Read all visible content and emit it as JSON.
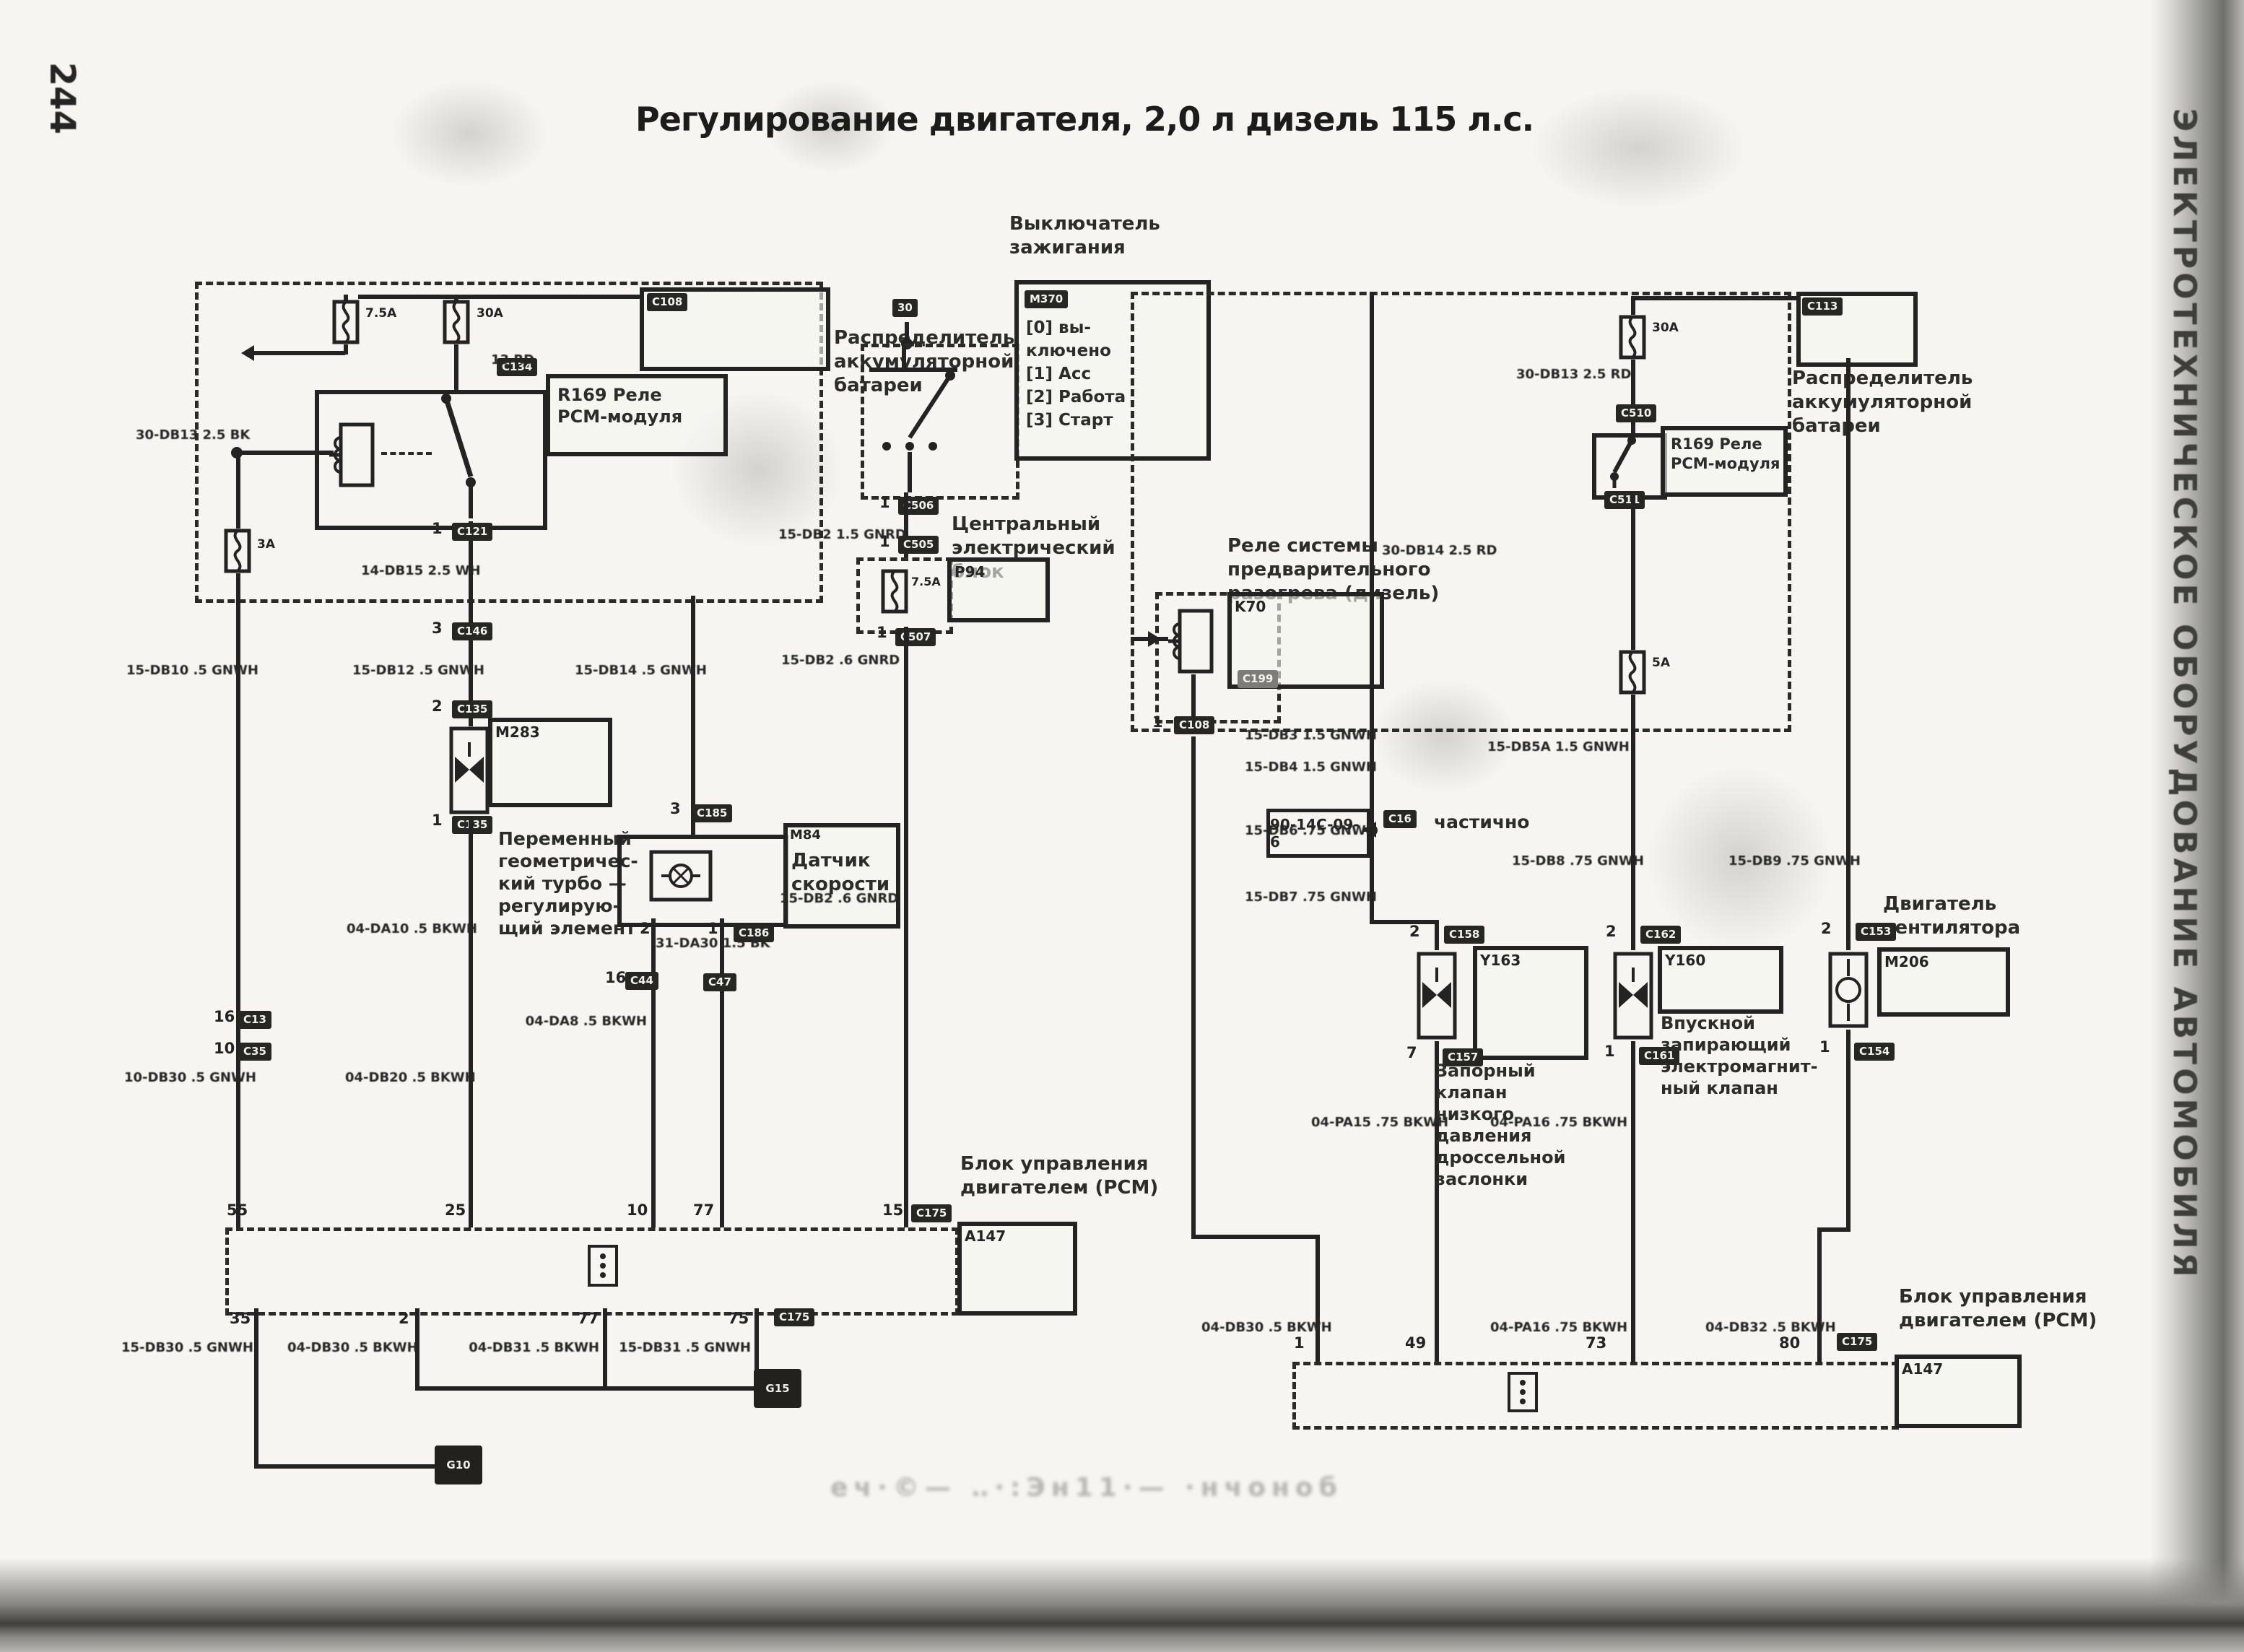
{
  "page": {
    "number": "244",
    "title": "Регулирование двигателя, 2,0 л дизель 115 л.с.",
    "sidebar": "ЭЛЕКТРОТЕХНИЧЕСКОЕ ОБОРУДОВАНИЕ АВТОМОБИЛЯ",
    "ghost": "еч·©— ‥·:Эн11·— ·нчоноб"
  },
  "left": {
    "dist1": "Распределитель",
    "dist2": "аккумуляторной",
    "dist3": "батареи",
    "dist_tag": "C108",
    "fuse1": "7.5A",
    "fuse2": "30A",
    "fuse3": "3A",
    "cb_fuse": "7.5A",
    "relay1": "R169 Реле",
    "relay2": "PCM-модуля",
    "ign_t1": "Выключатель",
    "ign_t2": "зажигания",
    "ign_tag": "M370",
    "ign_feed": "30",
    "ign0a": "[0] вы-",
    "ign0b": "ключено",
    "ign1": "[1] Acc",
    "ign2": "[2] Работа",
    "ign3": "[3] Старт",
    "cb1": "Центральный",
    "cb2": "электрический блок",
    "cb_tag": "P94",
    "turbo_tag": "M283",
    "turbo1": "Переменный",
    "turbo2": "геометричес-",
    "turbo3": "кий турбо —",
    "turbo4": "регулирую-",
    "turbo5": "щий элемент",
    "sens_tag": "M84",
    "sens1": "Датчик",
    "sens2": "скорости",
    "pcm1": "Блок управления",
    "pcm2": "двигателем (PCM)",
    "pcm_tag": "A147",
    "wires": [
      "30-DB13 2.5 BK",
      "13 RD",
      "14-DB15 2.5 WH",
      "15-DB10 .5 GNWH",
      "15-DB12 .5 GNWH",
      "15-DB14 .5 GNWH",
      "15-DB2 1.5 GNRD",
      "15-DB2 .6 GNRD",
      "31-DA30 1.5 BK",
      "04-DA10 .5 BKWH",
      "04-DA8 .5 BKWH",
      "10-DB30 .5 GNWH",
      "04-DB20 .5 BKWH",
      "15-DB2 .6 GNRD",
      "15-DB30 .5 GNWH",
      "04-DB30 .5 BKWH",
      "04-DB31 .5 BKWH",
      "15-DB31 .5 GNWH"
    ],
    "ctags": [
      "C134",
      "C121",
      "C146",
      "C135",
      "C135",
      "C185",
      "C186",
      "C506",
      "C505",
      "C507",
      "C13",
      "C35",
      "C44",
      "C47",
      "C175",
      "C175"
    ],
    "pins": {
      "relay_out": "1",
      "c146": "3",
      "turbo_top": "2",
      "turbo_bot": "1",
      "sens_top": "3",
      "sens2": "2",
      "sens1": "1",
      "v1a": "16",
      "v1b": "10",
      "c44": "16",
      "ign": "1",
      "cb_top": "1",
      "cb_bot": "1",
      "t55": "55",
      "t25": "25",
      "t10": "10",
      "t77": "77",
      "t15": "15",
      "b35": "35",
      "b2": "2",
      "b77": "77",
      "b75": "75"
    },
    "grounds": [
      "G10",
      "G15"
    ]
  },
  "right": {
    "dist1": "Распределитель",
    "dist2": "аккумуляторной",
    "dist3": "батареи",
    "dist_tag": "C113",
    "fuse1": "30A",
    "fuse2": "5A",
    "relay1": "R169 Реле",
    "relay2": "PCM-модуля",
    "ph1": "Реле системы предварительного",
    "ph2": "разогрева (дизель)",
    "ph_tag": "K70",
    "xref": "90-14C-09-6",
    "xref_note": "частично",
    "v1_tag": "Y163",
    "v1l1": "Запорный клапан",
    "v1l2": "низкого давления",
    "v1l3": "дроссельной",
    "v1l4": "заслонки",
    "v2_tag": "Y160",
    "v2l1": "Впускной",
    "v2l2": "запирающий",
    "v2l3": "электромагнит-",
    "v2l4": "ный клапан",
    "fan_tag": "M206",
    "fan1": "Двигатель",
    "fan2": "вентилятора",
    "pcm1": "Блок управления",
    "pcm2": "двигателем (PCM)",
    "pcm_tag": "A147",
    "wires": [
      "30-DB13 2.5 RD",
      "30-DB14 2.5 RD",
      "15-DB3 1.5 GNWH",
      "15-DB5A 1.5 GNWH",
      "15-DB4 1.5 GNWH",
      "15-DB6 .75 GNWH",
      "15-DB7 .75 GNWH",
      "15-DB8 .75 GNWH",
      "15-DB9 .75 GNWH",
      "04-PA15 .75 BKWH",
      "04-PA16 .75 BKWH",
      "04-DB30 .5 BKWH",
      "04-PA16 .75 BKWH",
      "04-DB32 .5 BKWH"
    ],
    "ctags": [
      "C113",
      "C510",
      "C511",
      "C108",
      "C199",
      "C16",
      "C158",
      "C157",
      "C162",
      "C161",
      "C153",
      "C154",
      "C175"
    ],
    "pins": {
      "ph": "1",
      "v1t": "2",
      "v1b": "7",
      "v2t": "2",
      "v2b": "1",
      "ft": "2",
      "fb": "1",
      "p1": "1",
      "p49": "49",
      "p73": "73",
      "p80": "80"
    }
  }
}
